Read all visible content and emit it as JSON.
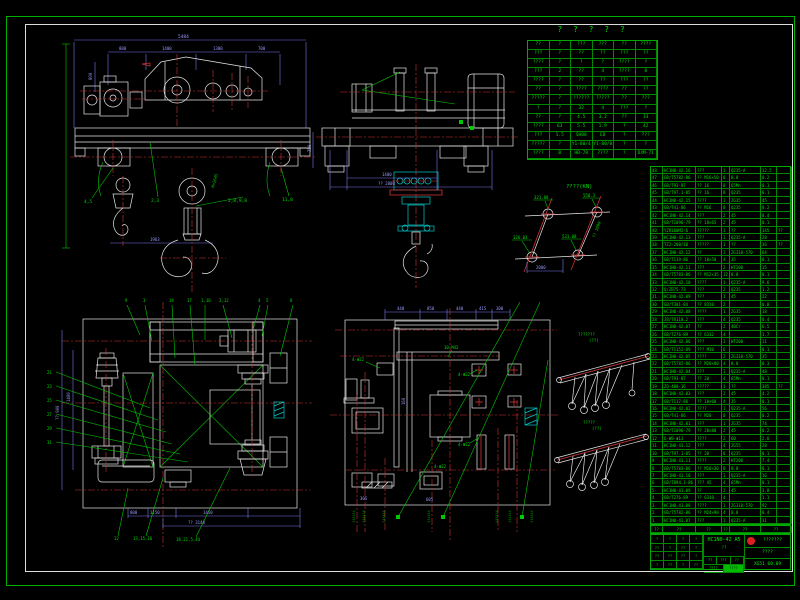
{
  "sheet": {
    "title": "? ? ? ? ?"
  },
  "front": {
    "dim_overall": "5484",
    "top_dims": [
      "800",
      "1400",
      "1300",
      "700"
    ],
    "dim_800": "800",
    "dim_750": "750",
    "dim_1963": "1963",
    "note": "H=2645",
    "item_labels": [
      "4,5",
      "2,3",
      "2,8,9,8",
      "11,8"
    ]
  },
  "side": {
    "dim_1400": "1400",
    "dim_2000": "?? 2000"
  },
  "wheel_load": {
    "title": "????(KN)",
    "tl": "321.88",
    "tr": "550.3",
    "bl": "326.03",
    "br": "531.08",
    "dim": "2000",
    "side": "?? 2000"
  },
  "reeving": {
    "t_title": "???????",
    "t_sub": "(??)",
    "b_title": "?????",
    "b_sub": "(??)"
  },
  "plan_left": {
    "top_labels": [
      "9",
      "3",
      "14",
      "17",
      "1,16",
      "2,12",
      "4",
      "5",
      "8"
    ],
    "left_labels": [
      "21",
      "23",
      "25",
      "27",
      "29",
      "31"
    ],
    "bottom_labels": [
      "12",
      "13,15,16",
      "18,21,5,44"
    ],
    "dims": [
      "800",
      "1150",
      "1450"
    ],
    "overall": "?? 3140",
    "left_dim1": "1400",
    "left_dim2": "?? 900"
  },
  "plan_mid": {
    "top_dims": [
      "440",
      "850",
      "440",
      "415",
      "300"
    ],
    "rail_label": "10-M42",
    "holes": [
      "4-Φ22",
      "4-Φ22",
      "4-Φ22",
      "4-Φ22"
    ],
    "small_dims": [
      "160",
      "305",
      "605"
    ],
    "vstrips": [
      "??????",
      "??????",
      "??????",
      "??????",
      "??????",
      "??????",
      "??????"
    ]
  },
  "spec_table": {
    "rows": [
      [
        "??",
        "?",
        "???",
        "???",
        "??",
        "????"
      ],
      [
        "???",
        "?",
        "??",
        "??",
        "???",
        "??"
      ],
      [
        "????",
        "?",
        "?",
        "?",
        "????",
        "?"
      ],
      [
        "???",
        "2",
        "??",
        "4",
        "????",
        "8"
      ],
      [
        "????",
        "?",
        "??",
        "??",
        "???",
        "??"
      ],
      [
        "??",
        "?",
        "????",
        "????",
        "??",
        "??"
      ],
      [
        "?????",
        "?",
        "??????",
        "?????",
        "??",
        "???"
      ],
      [
        "?",
        "?",
        "32",
        "4",
        "???",
        "?"
      ],
      [
        "??",
        "?",
        "4.5",
        "3.2",
        "??",
        "13"
      ],
      [
        "????",
        "63",
        "5.5",
        "1.9",
        "?",
        "42"
      ],
      [
        "???",
        "1.5",
        "SH08",
        "ED",
        "?",
        "???"
      ],
      [
        "?????",
        "?",
        "Y1-80/4",
        "Y1-80/8",
        "?",
        "?"
      ],
      [
        "????",
        "B",
        "HB-78",
        "????",
        "?",
        "DXM-71"
      ]
    ]
  },
  "bom": {
    "rows": [
      [
        "48",
        "HC1N0-42.16",
        "???",
        "1",
        "Q235-A",
        "12.5",
        ""
      ],
      [
        "47",
        "GB/T5782-86",
        "?? M16×50",
        "8",
        "8.8",
        "0.2",
        ""
      ],
      [
        "46",
        "GB/T93-87",
        "?? 16",
        "8",
        "65Mn",
        "0.1",
        ""
      ],
      [
        "45",
        "GB/T97.1-85",
        "?? 16",
        "8",
        "Q235",
        "0.1",
        ""
      ],
      [
        "44",
        "HC1N0-42.15",
        "????",
        "1",
        "ZG35",
        "45",
        ""
      ],
      [
        "43",
        "GB/T41-86",
        "?? M16",
        "8",
        "Q235",
        "0.2",
        ""
      ],
      [
        "42",
        "HC1N0-42.14",
        "???",
        "2",
        "45",
        "8.4",
        ""
      ],
      [
        "41",
        "GB/T1096-79",
        "?? 18×65",
        "2",
        "45",
        "0.1",
        ""
      ],
      [
        "40",
        "YZR160M2-6",
        "?????",
        "1",
        "??",
        "145",
        "??"
      ],
      [
        "39",
        "HC1N0-42.13",
        "???",
        "1",
        "Q235-A",
        "28",
        ""
      ],
      [
        "38",
        "TZ2-200/10",
        "?????",
        "1",
        "??",
        "36",
        "??"
      ],
      [
        "37",
        "HC1N0-42.12",
        "??",
        "1",
        "ZG310-570",
        "64",
        ""
      ],
      [
        "36",
        "GB/T119-86",
        "?? 10×50",
        "4",
        "35",
        "0.1",
        ""
      ],
      [
        "35",
        "HC1N0-42.11",
        "???",
        "2",
        "HT200",
        "15",
        ""
      ],
      [
        "34",
        "GB/T5783-86",
        "?? M12×35",
        "12",
        "8.8",
        "0.1",
        ""
      ],
      [
        "33",
        "HC1N0-42.10",
        "????",
        "1",
        "Q235-A",
        "9.6",
        ""
      ],
      [
        "32",
        "Q/ZB75-73",
        "???",
        "2",
        "Q235",
        "1.2",
        ""
      ],
      [
        "31",
        "HC1N0-42.09",
        "???",
        "1",
        "45",
        "22",
        ""
      ],
      [
        "30",
        "GB/T301-84",
        "?? 8310",
        "2",
        "",
        "0.8",
        ""
      ],
      [
        "29",
        "HC1N0-42.08",
        "????",
        "1",
        "ZG35",
        "18",
        ""
      ],
      [
        "28",
        "JB/T8110.2",
        "???",
        "4",
        "Q235",
        "0.4",
        ""
      ],
      [
        "27",
        "HC1N0-42.07",
        "??",
        "2",
        "40Cr",
        "6.5",
        ""
      ],
      [
        "26",
        "GB/T276-89",
        "?? 6312",
        "4",
        "",
        "1.7",
        ""
      ],
      [
        "25",
        "HC1N0-42.06",
        "???",
        "1",
        "HT200",
        "11",
        ""
      ],
      [
        "24",
        "GB/T1152-89",
        "??? M10",
        "6",
        "",
        "0.1",
        ""
      ],
      [
        "23",
        "HC1N0-42.05",
        "????",
        "2",
        "ZG310-570",
        "35",
        ""
      ],
      [
        "22",
        "GB/T5782-86",
        "?? M20×80",
        "4",
        "8.8",
        "0.3",
        ""
      ],
      [
        "21",
        "HC1N0-42.04",
        "???",
        "1",
        "Q235-A",
        "48",
        ""
      ],
      [
        "20",
        "GB/T93-87",
        "?? 20",
        "4",
        "65Mn",
        "0.1",
        ""
      ],
      [
        "19",
        "ZQ-400-16",
        "?????",
        "1",
        "??",
        "385",
        "??"
      ],
      [
        "18",
        "HC1N0-42.03",
        "???",
        "2",
        "45",
        "4.2",
        ""
      ],
      [
        "17",
        "GB/T117-86",
        "?? 10×60",
        "4",
        "35",
        "0.1",
        ""
      ],
      [
        "16",
        "HC1N0-42.02",
        "????",
        "1",
        "Q235-A",
        "56",
        ""
      ],
      [
        "15",
        "GB/T41-86",
        "?? M20",
        "8",
        "Q235",
        "0.2",
        ""
      ],
      [
        "14",
        "HC1N0-42.01",
        "???",
        "1",
        "ZG35",
        "74",
        ""
      ],
      [
        "13",
        "GB/T1096-79",
        "?? 20×80",
        "2",
        "45",
        "0.2",
        ""
      ],
      [
        "12",
        "6-W9-Φ13",
        "????",
        "2",
        "60",
        "2.6",
        ""
      ],
      [
        "11",
        "HC1N0-41.12",
        "???",
        "4",
        "ZG55",
        "28",
        ""
      ],
      [
        "10",
        "GB/T97.1-85",
        "?? 20",
        "8",
        "Q235",
        "0.1",
        ""
      ],
      [
        "9",
        "HC1N0-41.11",
        "????",
        "2",
        "HT200",
        "7.4",
        ""
      ],
      [
        "8",
        "GB/T5783-86",
        "?? M10×30",
        "8",
        "8.8",
        "0.1",
        ""
      ],
      [
        "7",
        "HC1N0-41.10",
        "???",
        "1",
        "Q235-A",
        "16",
        ""
      ],
      [
        "6",
        "GB/T894.1-86",
        "??? 45",
        "4",
        "65Mn",
        "0.1",
        ""
      ],
      [
        "5",
        "HC1N0-41.09",
        "??",
        "2",
        "45",
        "3.8",
        ""
      ],
      [
        "4",
        "GB/T276-89",
        "?? 6310",
        "4",
        "",
        "1.1",
        ""
      ],
      [
        "3",
        "HC1N0-41.08",
        "????",
        "1",
        "ZG310-570",
        "92",
        ""
      ],
      [
        "2",
        "GB/T5782-86",
        "?? M24×90",
        "4",
        "8.8",
        "0.4",
        ""
      ],
      [
        "1",
        "HC1N0-41.07",
        "???",
        "1",
        "Q235-A",
        "31",
        ""
      ]
    ]
  },
  "title_block": {
    "footer_cells": [
      "??",
      "??",
      "??",
      "??",
      "??",
      "??"
    ],
    "left_rows": [
      [
        "?",
        "?",
        "?",
        "?"
      ],
      [
        "??",
        "?",
        "??",
        "?"
      ],
      [
        "??",
        "??",
        "??",
        "?"
      ],
      [
        "?",
        "??",
        "?",
        "??"
      ]
    ],
    "drawing_no": "HC1N0-42 A5",
    "drawing_sub": "??",
    "mid_cells": [
      "??",
      "???",
      "??",
      "????",
      "????"
    ],
    "company": "???????",
    "product": "????",
    "code": "XG51 60.09"
  }
}
